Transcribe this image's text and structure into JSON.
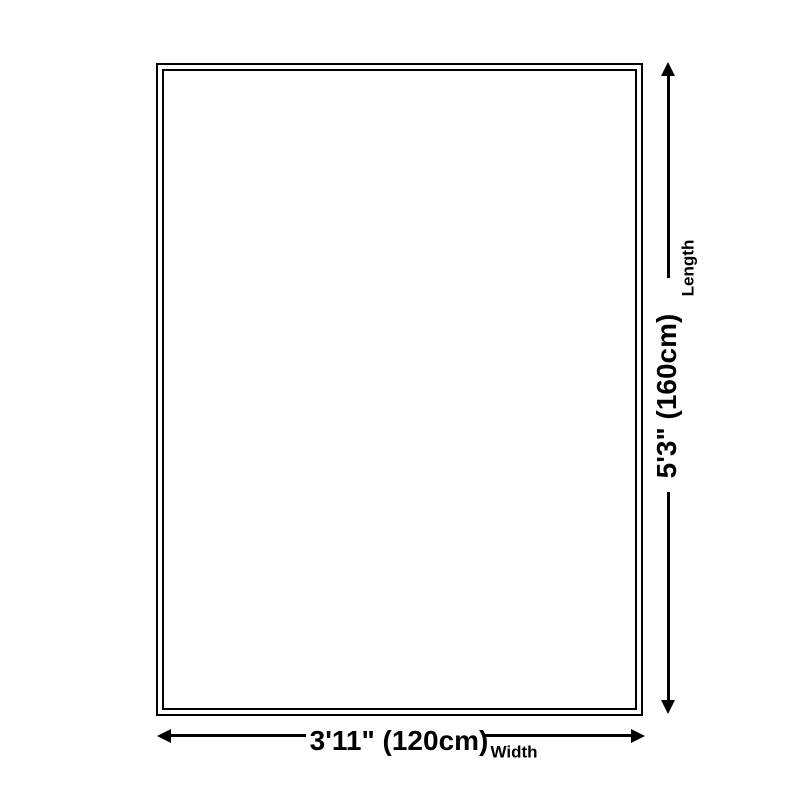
{
  "diagram": {
    "length": {
      "value": "5'3\" (160cm)",
      "label": "Length"
    },
    "width": {
      "value": "3'11\" (120cm)",
      "label": "Width"
    },
    "colors": {
      "line": "#000000",
      "background": "#ffffff"
    }
  }
}
